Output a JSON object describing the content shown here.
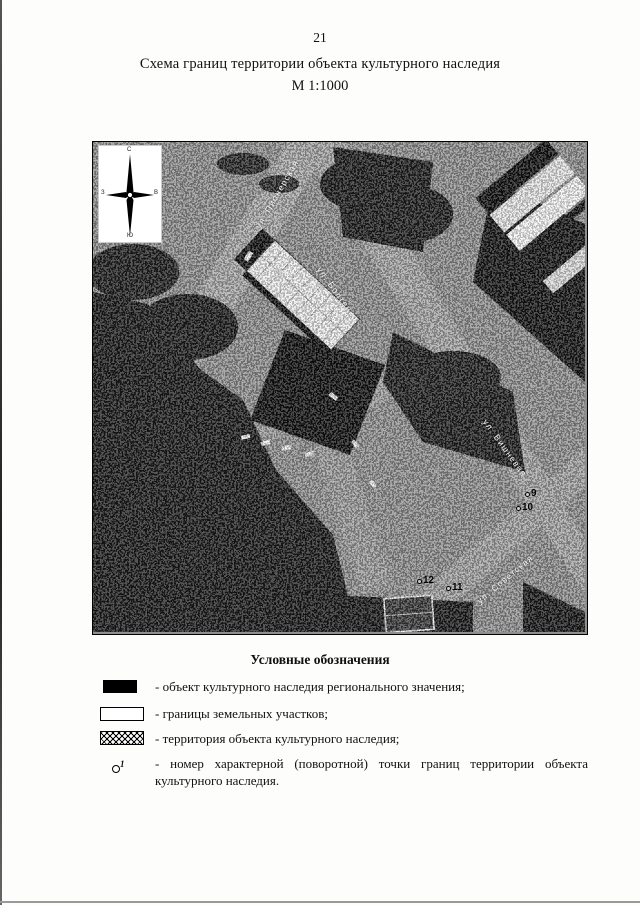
{
  "page": {
    "number": "21",
    "title": "Схема границ территории объекта культурного наследия",
    "scale": "М 1:1000"
  },
  "map": {
    "compass": {
      "north": "С",
      "south": "Ю",
      "west": "З",
      "east": "В"
    },
    "street_labels": [
      "ул. Пионерская",
      "ул. Болтенко",
      "ул. Вишневая",
      "ул. Советская"
    ],
    "point_numbers": [
      "9",
      "10",
      "12",
      "11"
    ]
  },
  "legend": {
    "title": "Условные обозначения",
    "items": [
      {
        "symbol": "filled-black-rect",
        "label": "- объект культурного наследия регионального значения;"
      },
      {
        "symbol": "outlined-rect",
        "label": "- границы земельных участков;"
      },
      {
        "symbol": "cross-hatched-rect",
        "label": "- территория объекта культурного наследия;"
      },
      {
        "symbol": "numbered-point",
        "symbol_text": "1",
        "label": "- номер характерной (поворотной) точки границ территории объекта культурного наследия."
      }
    ]
  }
}
